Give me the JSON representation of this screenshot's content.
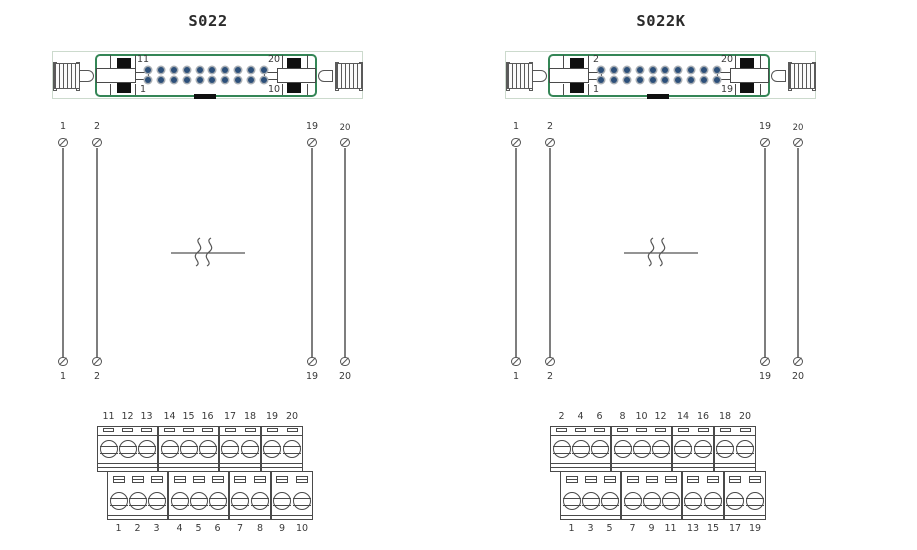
{
  "colors": {
    "connector_frame_green": "#348656",
    "assembly_outline": "#ccdacd",
    "pin_dot_blue": "#2d507a",
    "pin_dot_ring": "#a9aeb3",
    "line_dark": "#4a4a4a",
    "wire_gray": "#7e7e7e",
    "polarization_key_black": "#101010",
    "text": "#3a3a3a"
  },
  "diagrams": [
    {
      "title": "S022",
      "connector": {
        "top_left_pin": "11",
        "bottom_left_pin": "1",
        "top_right_pin": "20",
        "bottom_right_pin": "10",
        "pin_rows": 2,
        "pin_cols": 10
      },
      "wires": {
        "top_labels": [
          "1",
          "2",
          "19",
          "20"
        ],
        "bottom_labels": [
          "1",
          "2",
          "19",
          "20"
        ]
      },
      "terminals": {
        "top_groups": [
          [
            "11",
            "12",
            "13"
          ],
          [
            "14",
            "15",
            "16"
          ],
          [
            "17",
            "18"
          ],
          [
            "19",
            "20"
          ]
        ],
        "bottom_groups": [
          [
            "1",
            "2",
            "3"
          ],
          [
            "4",
            "5",
            "6"
          ],
          [
            "7",
            "8"
          ],
          [
            "9",
            "10"
          ]
        ]
      }
    },
    {
      "title": "S022K",
      "connector": {
        "top_left_pin": "2",
        "bottom_left_pin": "1",
        "top_right_pin": "20",
        "bottom_right_pin": "19",
        "pin_rows": 2,
        "pin_cols": 10
      },
      "wires": {
        "top_labels": [
          "1",
          "2",
          "19",
          "20"
        ],
        "bottom_labels": [
          "1",
          "2",
          "19",
          "20"
        ]
      },
      "terminals": {
        "top_groups": [
          [
            "2",
            "4",
            "6"
          ],
          [
            "8",
            "10",
            "12"
          ],
          [
            "14",
            "16"
          ],
          [
            "18",
            "20"
          ]
        ],
        "bottom_groups": [
          [
            "1",
            "3",
            "5"
          ],
          [
            "7",
            "9",
            "11"
          ],
          [
            "13",
            "15"
          ],
          [
            "17",
            "19"
          ]
        ]
      }
    }
  ]
}
